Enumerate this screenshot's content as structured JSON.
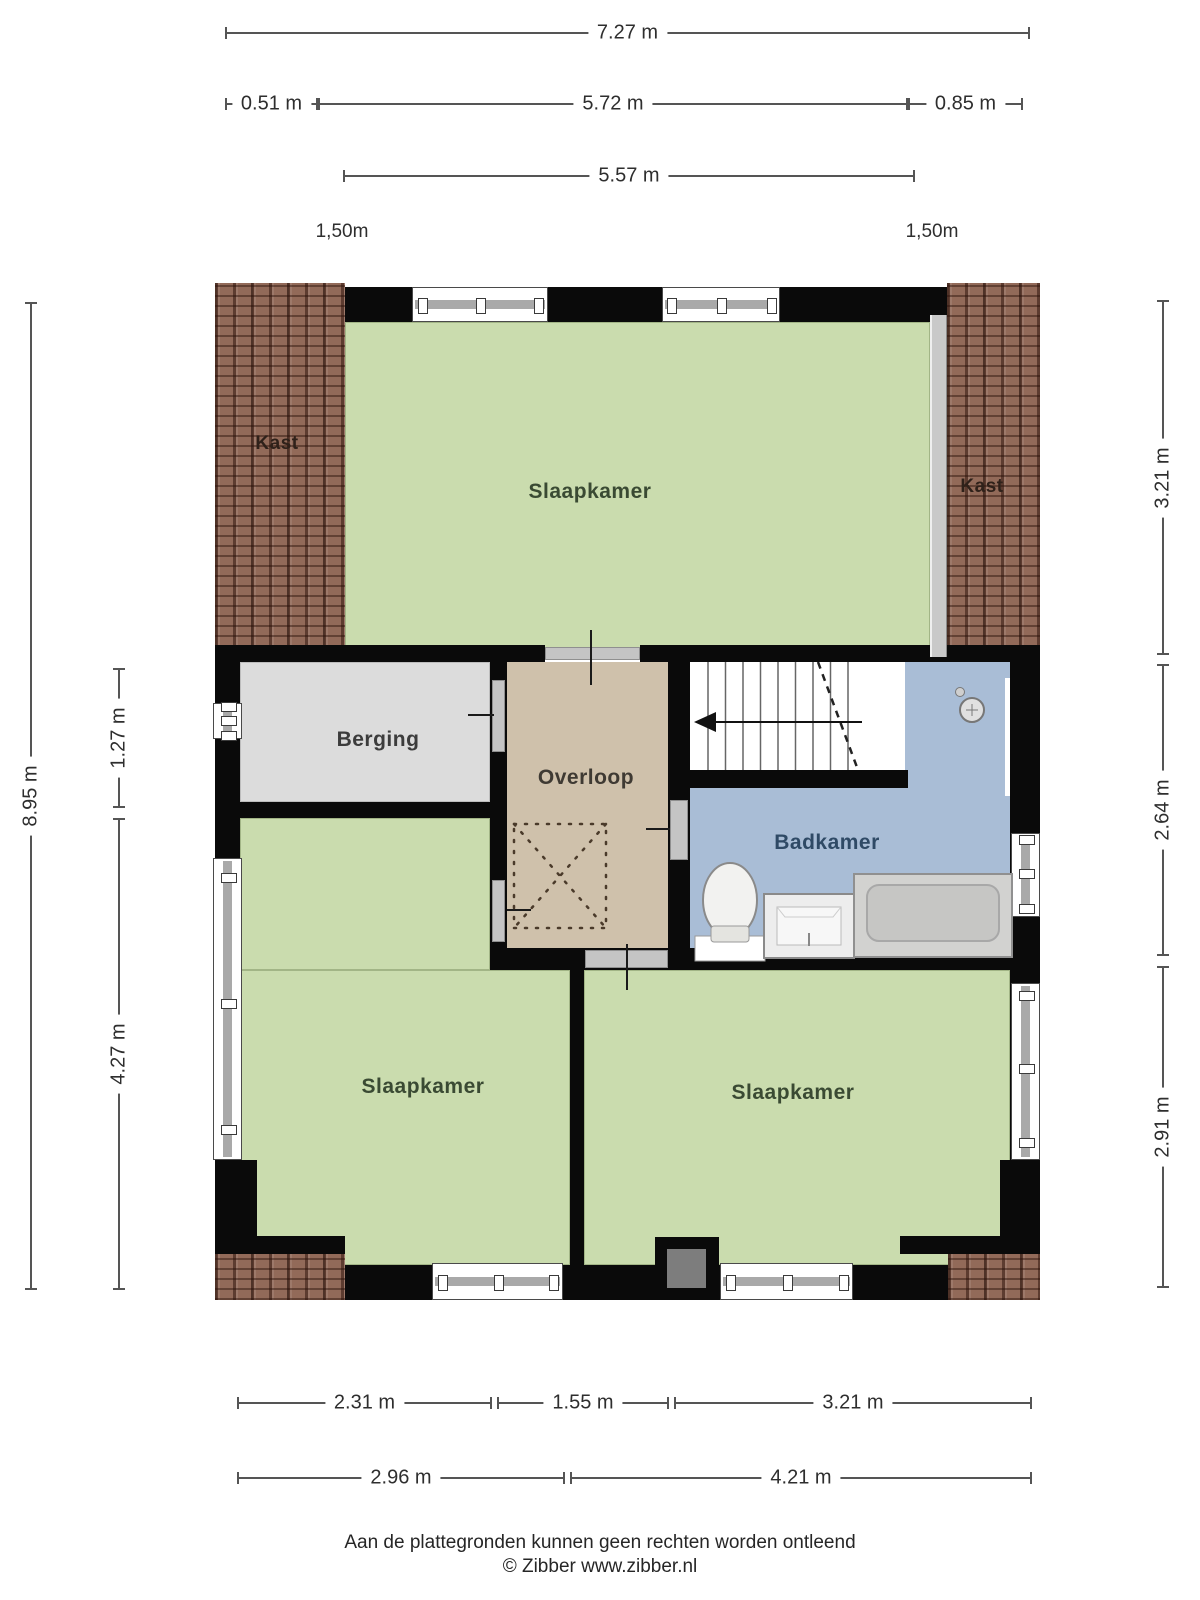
{
  "rooms": {
    "kast_left": {
      "label": "Kast"
    },
    "slaapkamer_top": {
      "label": "Slaapkamer"
    },
    "kast_right": {
      "label": "Kast"
    },
    "berging": {
      "label": "Berging"
    },
    "overloop": {
      "label": "Overloop"
    },
    "badkamer": {
      "label": "Badkamer"
    },
    "slaapkamer_left": {
      "label": "Slaapkamer"
    },
    "slaapkamer_right": {
      "label": "Slaapkamer"
    }
  },
  "dimensions": {
    "top": {
      "total": "7.27 m",
      "left_offset": "0.51 m",
      "inner": "5.72 m",
      "right_offset": "0.85 m",
      "second": "5.57 m",
      "knee_left": "1,50m",
      "knee_right": "1,50m"
    },
    "left": {
      "total": "8.95 m",
      "upper": "1.27 m",
      "lower": "4.27 m"
    },
    "right": {
      "upper": "3.21 m",
      "middle": "2.64 m",
      "lower": "2.91 m"
    },
    "bottom": {
      "row1": [
        "2.31 m",
        "1.55 m",
        "3.21 m"
      ],
      "row2": [
        "2.96 m",
        "4.21 m"
      ]
    }
  },
  "footer": {
    "disclaimer": "Aan de plattegronden kunnen geen rechten worden ontleend",
    "copyright": "© Zibber www.zibber.nl"
  },
  "colors": {
    "room_green": "#cadcae",
    "hall_tan": "#cfc1ab",
    "bath_blue": "#a9bdd6",
    "storage_gray": "#dcdcdc",
    "wall_black": "#0a0a0a",
    "roof_brick": "#926a59",
    "window_bar": "#a9a9a9"
  },
  "fixtures": [
    "staircase",
    "toilet",
    "sink",
    "bathtub",
    "shower-head",
    "skylight-dashed-box",
    "chimney"
  ]
}
